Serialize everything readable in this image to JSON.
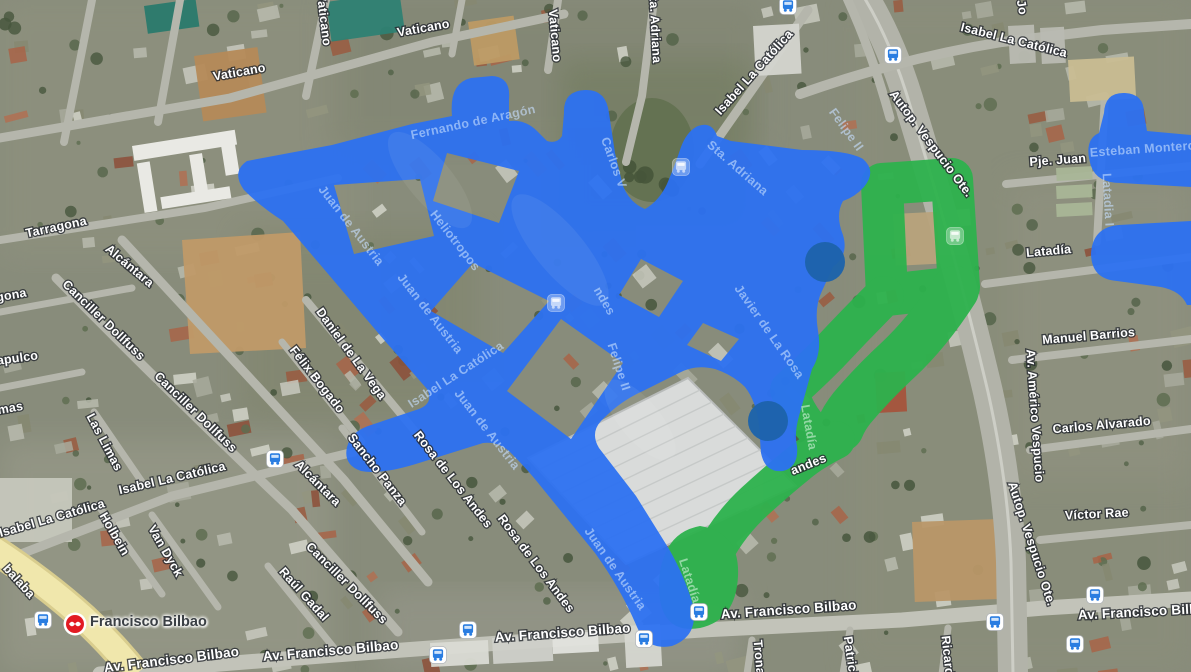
{
  "map": {
    "station": {
      "name": "Francisco Bilbao",
      "x": 75,
      "y": 624
    },
    "overlay_colors": {
      "blue": "#2c71f2",
      "green": "#2db24d",
      "dot": "#1d63ab"
    },
    "route_overlays": {
      "blue_main": [
        "M 244,190 Q 231,172 247,161 L 332,145 L 412,124 L 452,116 Q 449,83 471,78 L 492,76 Q 511,77 509,99 L 509,121 Q 525,119 537,131 L 547,141 Q 557,144 562,136 L 564,113 Q 563,91 585,90 Q 606,89 609,113 L 615,153 L 623,186 Q 630,203 645,209 Q 659,201 667,184 Q 675,165 681,147 Q 687,131 698,126 Q 712,121 717,136 L 731,141 L 802,150 Q 848,150 863,159 Q 877,171 864,187 Q 855,197 843,201 Q 835,215 843,235 Q 849,255 833,267 L 822,291 Q 814,307 818,331 Q 822,353 812,369 L 806,391 L 799,416 Q 794,434 797,446 Q 799,467 783,471 Q 765,473 761,453 L 759,425 Q 756,401 745,387 Q 733,375 715,369 Q 695,364 679,373 L 643,391 Q 620,401 601,421 Q 590,433 599,448 L 636,496 L 669,549 Q 685,577 693,605 Q 699,636 672,646 Q 647,651 637,627 Q 621,589 595,553 L 543,489 Q 529,471 511,453 Q 499,441 483,443 L 419,463 Q 381,475 361,471 Q 343,465 347,447 Q 351,431 371,425 L 419,409 Q 434,403 427,389 L 385,341 L 329,275 L 283,221 Q 261,207 244,190 Z",
        "M 334,185 L 420,179 L 434,236 L 354,254 Z",
        "M 447,153 L 519,171 L 499,223 L 433,201 Z",
        "M 473,263 L 549,301 L 503,353 L 431,311 Z",
        "M 561,319 L 623,363 L 571,439 L 507,391 Z",
        "M 641,259 L 683,281 L 659,317 L 619,295 Z",
        "M 703,323 L 739,339 L 721,361 L 687,345 Z"
      ],
      "blue_corner": [
        "M 1091,166 Q 1083,140 1099,133 L 1104,113 Q 1105,92 1125,93 Q 1144,94 1144,113 L 1147,131 L 1191,135 L 1191,187 L 1121,183 Q 1097,183 1091,166 Z",
        "M 1119,225 Q 1093,227 1091,253 Q 1091,279 1117,281 L 1161,287 Q 1181,291 1187,305 L 1191,305 L 1191,221 Z"
      ],
      "green_strokes": [
        {
          "d": "M 882,184 L 952,179 L 959,287 L 887,295 Z",
          "w": 42
        },
        {
          "d": "M 955,290 Q 928,332 898,360 Q 872,384 852,408 Q 844,418 840,428",
          "w": 48
        },
        {
          "d": "M 884,296 Q 856,324 828,354 Q 806,376 790,390",
          "w": 40
        },
        {
          "d": "M 792,394 Q 804,428 832,444",
          "w": 34
        },
        {
          "d": "M 836,440 Q 812,452 798,464 Q 778,480 754,502 Q 726,528 710,562",
          "w": 38
        }
      ],
      "green_blob": "M 700,526 Q 740,532 738,576 Q 736,620 700,628 Q 666,634 660,600 Q 656,570 668,548 Q 678,530 700,526 Z",
      "dots": [
        {
          "x": 825,
          "y": 262,
          "r": 20
        },
        {
          "x": 768,
          "y": 421,
          "r": 20
        }
      ]
    },
    "street_labels": [
      {
        "text": "Vaticano",
        "x": 320,
        "y": 20,
        "rot": 83,
        "kind": "white"
      },
      {
        "text": "Vaticano",
        "x": 424,
        "y": 32,
        "rot": -10,
        "kind": "white"
      },
      {
        "text": "Vaticano",
        "x": 551,
        "y": 36,
        "rot": 85,
        "kind": "white"
      },
      {
        "text": "Vaticano",
        "x": 240,
        "y": 76,
        "rot": -10,
        "kind": "white"
      },
      {
        "text": "Tarragona",
        "x": 57,
        "y": 231,
        "rot": -12,
        "kind": "white"
      },
      {
        "text": "gona",
        "x": 12,
        "y": 299,
        "rot": -10,
        "kind": "white"
      },
      {
        "text": "Sta. Adriana",
        "x": 651,
        "y": 26,
        "rot": 87,
        "kind": "white"
      },
      {
        "text": "Isabel La Católica",
        "x": 757,
        "y": 75,
        "rot": -48,
        "kind": "white"
      },
      {
        "text": "Isabel La Católica",
        "x": 1013,
        "y": 44,
        "rot": 14,
        "kind": "white"
      },
      {
        "text": "Jo",
        "x": 1018,
        "y": 8,
        "rot": 80,
        "kind": "white"
      },
      {
        "text": "Pje. Juan",
        "x": 1058,
        "y": 164,
        "rot": -4,
        "kind": "white"
      },
      {
        "text": "Esteban Montero",
        "x": 1143,
        "y": 153,
        "rot": -4,
        "kind": "ghost-blue"
      },
      {
        "text": "Latadia I",
        "x": 1104,
        "y": 200,
        "rot": 87,
        "kind": "ghost-blue"
      },
      {
        "text": "Autop. Vespucio Ote.",
        "x": 928,
        "y": 146,
        "rot": 53,
        "kind": "white"
      },
      {
        "text": "Fernando de Aragón",
        "x": 474,
        "y": 126,
        "rot": -12,
        "kind": "ghost-blue"
      },
      {
        "text": "Carlos V",
        "x": 610,
        "y": 164,
        "rot": 70,
        "kind": "ghost-blue"
      },
      {
        "text": "Heliotropos",
        "x": 452,
        "y": 243,
        "rot": 52,
        "kind": "ghost-blue"
      },
      {
        "text": "Sta. Adriana",
        "x": 735,
        "y": 171,
        "rot": 41,
        "kind": "ghost-blue"
      },
      {
        "text": "Felipe II",
        "x": 843,
        "y": 132,
        "rot": 54,
        "kind": "ghost-blue"
      },
      {
        "text": "Felipe II",
        "x": 615,
        "y": 368,
        "rot": 72,
        "kind": "ghost-blue"
      },
      {
        "text": "Juan de Austria",
        "x": 348,
        "y": 228,
        "rot": 52,
        "kind": "ghost-blue"
      },
      {
        "text": "Juan de Austria",
        "x": 427,
        "y": 316,
        "rot": 52,
        "kind": "ghost-blue"
      },
      {
        "text": "Juan de Austria",
        "x": 484,
        "y": 432,
        "rot": 52,
        "kind": "ghost-blue"
      },
      {
        "text": "Juan de Austria",
        "x": 612,
        "y": 571,
        "rot": 55,
        "kind": "ghost-blue"
      },
      {
        "text": "Isabel La Católica",
        "x": 458,
        "y": 378,
        "rot": -33,
        "kind": "ghost-blue"
      },
      {
        "text": "ndes",
        "x": 601,
        "y": 303,
        "rot": 60,
        "kind": "ghost-blue"
      },
      {
        "text": "Javier de La Rosa",
        "x": 766,
        "y": 334,
        "rot": 55,
        "kind": "ghost-blue"
      },
      {
        "text": "Rosa de Los Andes",
        "x": 450,
        "y": 482,
        "rot": 52,
        "kind": "white"
      },
      {
        "text": "Rosa de Los Andes",
        "x": 533,
        "y": 566,
        "rot": 53,
        "kind": "white"
      },
      {
        "text": "Isabel La Católica",
        "x": 173,
        "y": 482,
        "rot": -13,
        "kind": "white"
      },
      {
        "text": "Isabel La Católica",
        "x": 53,
        "y": 522,
        "rot": -16,
        "kind": "white"
      },
      {
        "text": "Holbein",
        "x": 111,
        "y": 536,
        "rot": 60,
        "kind": "white"
      },
      {
        "text": "Van Dyck",
        "x": 162,
        "y": 553,
        "rot": 60,
        "kind": "white"
      },
      {
        "text": "Alcántara",
        "x": 127,
        "y": 269,
        "rot": 40,
        "kind": "white"
      },
      {
        "text": "Alcántara",
        "x": 315,
        "y": 486,
        "rot": 45,
        "kind": "white"
      },
      {
        "text": "Canciller Dollfuss",
        "x": 101,
        "y": 323,
        "rot": 44,
        "kind": "white"
      },
      {
        "text": "Canciller Dollfuss",
        "x": 193,
        "y": 415,
        "rot": 44,
        "kind": "white"
      },
      {
        "text": "Canciller Dollfuss",
        "x": 344,
        "y": 586,
        "rot": 45,
        "kind": "white"
      },
      {
        "text": "Daniel de La Vega",
        "x": 348,
        "y": 356,
        "rot": 54,
        "kind": "white"
      },
      {
        "text": "Félix Bogado",
        "x": 314,
        "y": 382,
        "rot": 52,
        "kind": "white"
      },
      {
        "text": "Sancho Panza",
        "x": 374,
        "y": 472,
        "rot": 52,
        "kind": "white"
      },
      {
        "text": "Raúl Gadal",
        "x": 301,
        "y": 597,
        "rot": 48,
        "kind": "white"
      },
      {
        "text": "Las Limas",
        "x": 101,
        "y": 444,
        "rot": 62,
        "kind": "white"
      },
      {
        "text": "mas",
        "x": 11,
        "y": 412,
        "rot": -10,
        "kind": "white"
      },
      {
        "text": "apulco",
        "x": 18,
        "y": 362,
        "rot": -8,
        "kind": "white"
      },
      {
        "text": "balaba",
        "x": 16,
        "y": 584,
        "rot": 48,
        "kind": "white"
      },
      {
        "text": "Av. Francisco Bilbao",
        "x": 172,
        "y": 664,
        "rot": -7,
        "kind": "white",
        "size": 13.5
      },
      {
        "text": "Av. Francisco Bilbao",
        "x": 331,
        "y": 655,
        "rot": -5,
        "kind": "white",
        "size": 13.5
      },
      {
        "text": "Av. Francisco Bilbao",
        "x": 563,
        "y": 637,
        "rot": -4,
        "kind": "white",
        "size": 13.5
      },
      {
        "text": "Av. Francisco Bilbao",
        "x": 789,
        "y": 614,
        "rot": -4,
        "kind": "white",
        "size": 13.5
      },
      {
        "text": "Av. Francisco Bilbao",
        "x": 1146,
        "y": 616,
        "rot": -3,
        "kind": "white",
        "size": 13.5
      },
      {
        "text": "Latadía",
        "x": 1049,
        "y": 255,
        "rot": -5,
        "kind": "white"
      },
      {
        "text": "Manuel Barrios",
        "x": 1089,
        "y": 340,
        "rot": -5,
        "kind": "white"
      },
      {
        "text": "Carlos Alvarado",
        "x": 1102,
        "y": 429,
        "rot": -5,
        "kind": "white"
      },
      {
        "text": "Víctor Rae",
        "x": 1097,
        "y": 518,
        "rot": -3,
        "kind": "white"
      },
      {
        "text": "Av. Américo Vespucio",
        "x": 1031,
        "y": 416,
        "rot": 86,
        "kind": "white"
      },
      {
        "text": "Autop. Vespucio Ote.",
        "x": 1028,
        "y": 545,
        "rot": 72,
        "kind": "white"
      },
      {
        "text": "Latadía",
        "x": 686,
        "y": 582,
        "rot": 72,
        "kind": "ghost-green"
      },
      {
        "text": "Latadía",
        "x": 805,
        "y": 428,
        "rot": 80,
        "kind": "ghost-green"
      },
      {
        "text": "andes",
        "x": 810,
        "y": 468,
        "rot": -22,
        "kind": "white"
      },
      {
        "text": "Tronador",
        "x": 756,
        "y": 668,
        "rot": 85,
        "kind": "white"
      },
      {
        "text": "Patricia",
        "x": 847,
        "y": 660,
        "rot": 82,
        "kind": "white"
      },
      {
        "text": "Ricardo",
        "x": 944,
        "y": 660,
        "rot": 84,
        "kind": "white"
      }
    ],
    "transit_stops": {
      "bus": [
        [
          788,
          6
        ],
        [
          893,
          55
        ],
        [
          275,
          459
        ],
        [
          43,
          620
        ],
        [
          468,
          630
        ],
        [
          438,
          655
        ],
        [
          644,
          639
        ],
        [
          699,
          612
        ],
        [
          1095,
          595
        ],
        [
          995,
          622
        ],
        [
          1075,
          644
        ]
      ],
      "bus_ghost_blue": [
        [
          556,
          303
        ],
        [
          681,
          167
        ]
      ],
      "bus_ghost_green": [
        [
          955,
          236
        ]
      ]
    }
  }
}
